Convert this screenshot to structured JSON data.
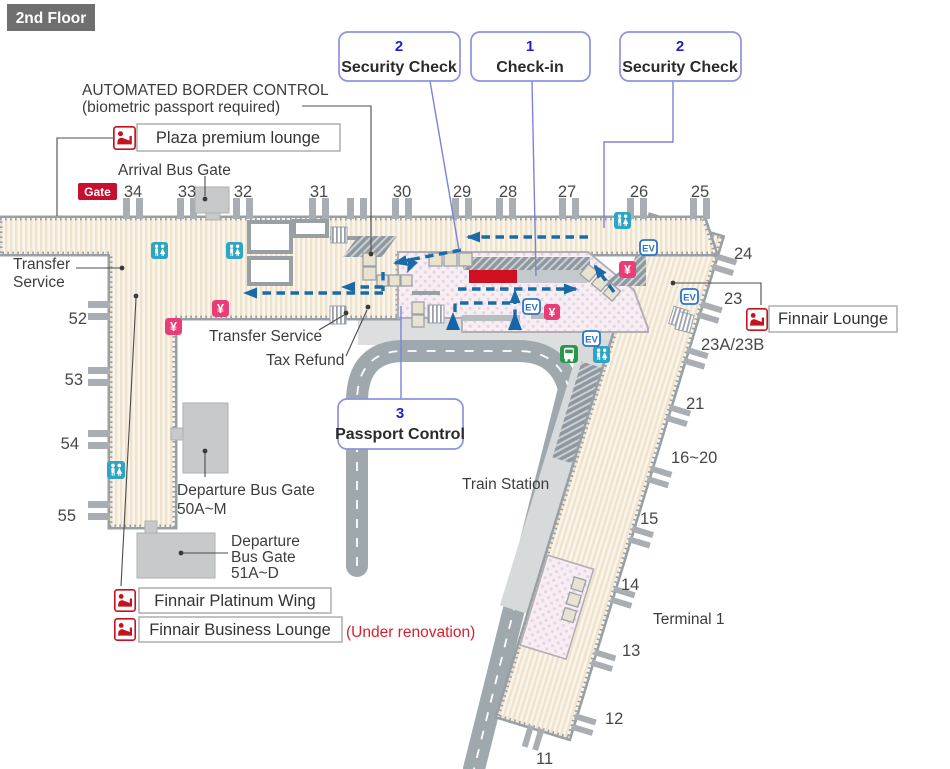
{
  "floor": {
    "label": "2nd Floor"
  },
  "callouts": {
    "security_left": {
      "num": "2",
      "label": "Security Check"
    },
    "checkin": {
      "num": "1",
      "label": "Check-in"
    },
    "security_right": {
      "num": "2",
      "label": "Security Check"
    },
    "passport": {
      "num": "3",
      "label": "Passport Control"
    }
  },
  "notes": {
    "abc1": "AUTOMATED BORDER CONTROL",
    "abc2": "(biometric passport  required)",
    "arrival_bus": "Arrival Bus Gate",
    "gate_badge": "Gate",
    "transfer_left1": "Transfer",
    "transfer_left2": "Service",
    "transfer_mid": "Transfer Service",
    "tax_refund": "Tax Refund",
    "train_station": "Train Station",
    "terminal1": "Terminal 1",
    "dep50_1": "Departure Bus Gate",
    "dep50_2": "50A~M",
    "dep51_1": "Departure",
    "dep51_2": "Bus Gate",
    "dep51_3": "51A~D",
    "under_renovation": "(Under renovation)"
  },
  "lounges": {
    "plaza": "Plaza premium lounge",
    "finnair": "Finnair Lounge",
    "platinum": "Finnair Platinum Wing",
    "business": "Finnair Business  Lounge"
  },
  "gates": {
    "top": [
      "34",
      "33",
      "32",
      "31",
      "30",
      "29",
      "28",
      "27",
      "26",
      "25"
    ],
    "left": [
      "52",
      "53",
      "54",
      "55"
    ],
    "right": [
      "24",
      "23",
      "23A/23B",
      "21",
      "16~20",
      "15",
      "14",
      "13",
      "12",
      "11"
    ]
  },
  "icons": {
    "elevator": "EV",
    "currency": "¥"
  },
  "colors": {
    "building_fill": "#faf5ea",
    "building_border": "#98a0a6",
    "flow_arrow": "#1b6aa8",
    "checkin_counter": "#cf1020",
    "hall_pink": "#f6eef3",
    "road": "#9fa8ad",
    "callout_border": "#8b93e0",
    "restroom": "#2fa5c5",
    "currency": "#ea3d78",
    "bus": "#27984a",
    "lounge_red": "#c6121f"
  }
}
